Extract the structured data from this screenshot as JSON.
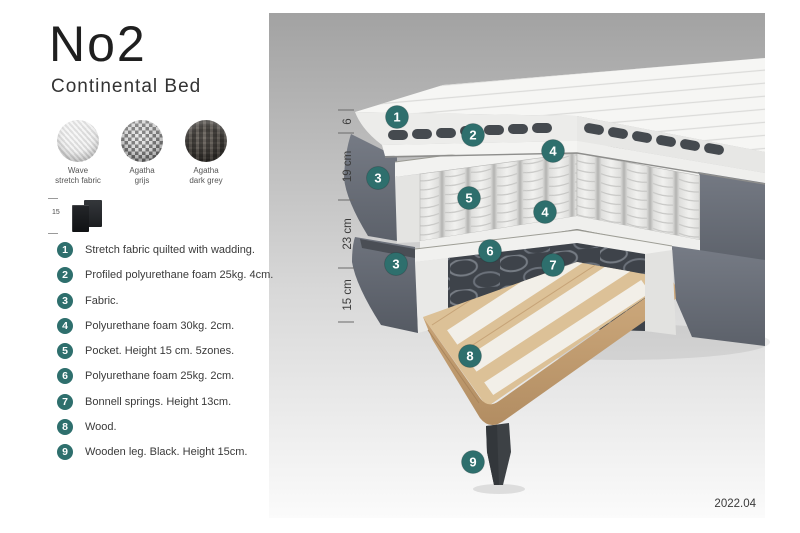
{
  "page": {
    "version_label": "2022.04"
  },
  "colors": {
    "accent_teal": "#2E6F6D",
    "panel_gradient_top": "#A2A2A2",
    "panel_gradient_bottom": "#FBFBFB",
    "fabric_grey": "#6B7079",
    "wood": "#DCC197",
    "leg_black": "#3D4145"
  },
  "header": {
    "title": "No2",
    "subtitle": "Continental Bed"
  },
  "swatches": [
    {
      "line1": "Wave",
      "line2": "stretch fabric"
    },
    {
      "line1": "Agatha",
      "line2": "grijs"
    },
    {
      "line1": "Agatha",
      "line2": "dark grey"
    }
  ],
  "leg_thumbnail": {
    "height_label": "15"
  },
  "legend": {
    "items": [
      {
        "num": "1",
        "text": "Stretch fabric quilted with wadding."
      },
      {
        "num": "2",
        "text": "Profiled polyurethane foam 25kg. 4cm."
      },
      {
        "num": "3",
        "text": "Fabric."
      },
      {
        "num": "4",
        "text": "Polyurethane foam 30kg. 2cm."
      },
      {
        "num": "5",
        "text": "Pocket. Height 15 cm. 5zones."
      },
      {
        "num": "6",
        "text": "Polyurethane foam 25kg. 2cm."
      },
      {
        "num": "7",
        "text": "Bonnell springs. Height 13cm."
      },
      {
        "num": "8",
        "text": "Wood."
      },
      {
        "num": "9",
        "text": "Wooden leg. Black. Height 15cm."
      }
    ]
  },
  "diagram": {
    "measurements": [
      {
        "label": "6"
      },
      {
        "label": "19 cm"
      },
      {
        "label": "23 cm"
      },
      {
        "label": "15 cm"
      }
    ],
    "callouts": [
      {
        "label": "1"
      },
      {
        "label": "2"
      },
      {
        "label": "4"
      },
      {
        "label": "3"
      },
      {
        "label": "5"
      },
      {
        "label": "4"
      },
      {
        "label": "6"
      },
      {
        "label": "7"
      },
      {
        "label": "3"
      },
      {
        "label": "8"
      },
      {
        "label": "9"
      }
    ]
  }
}
